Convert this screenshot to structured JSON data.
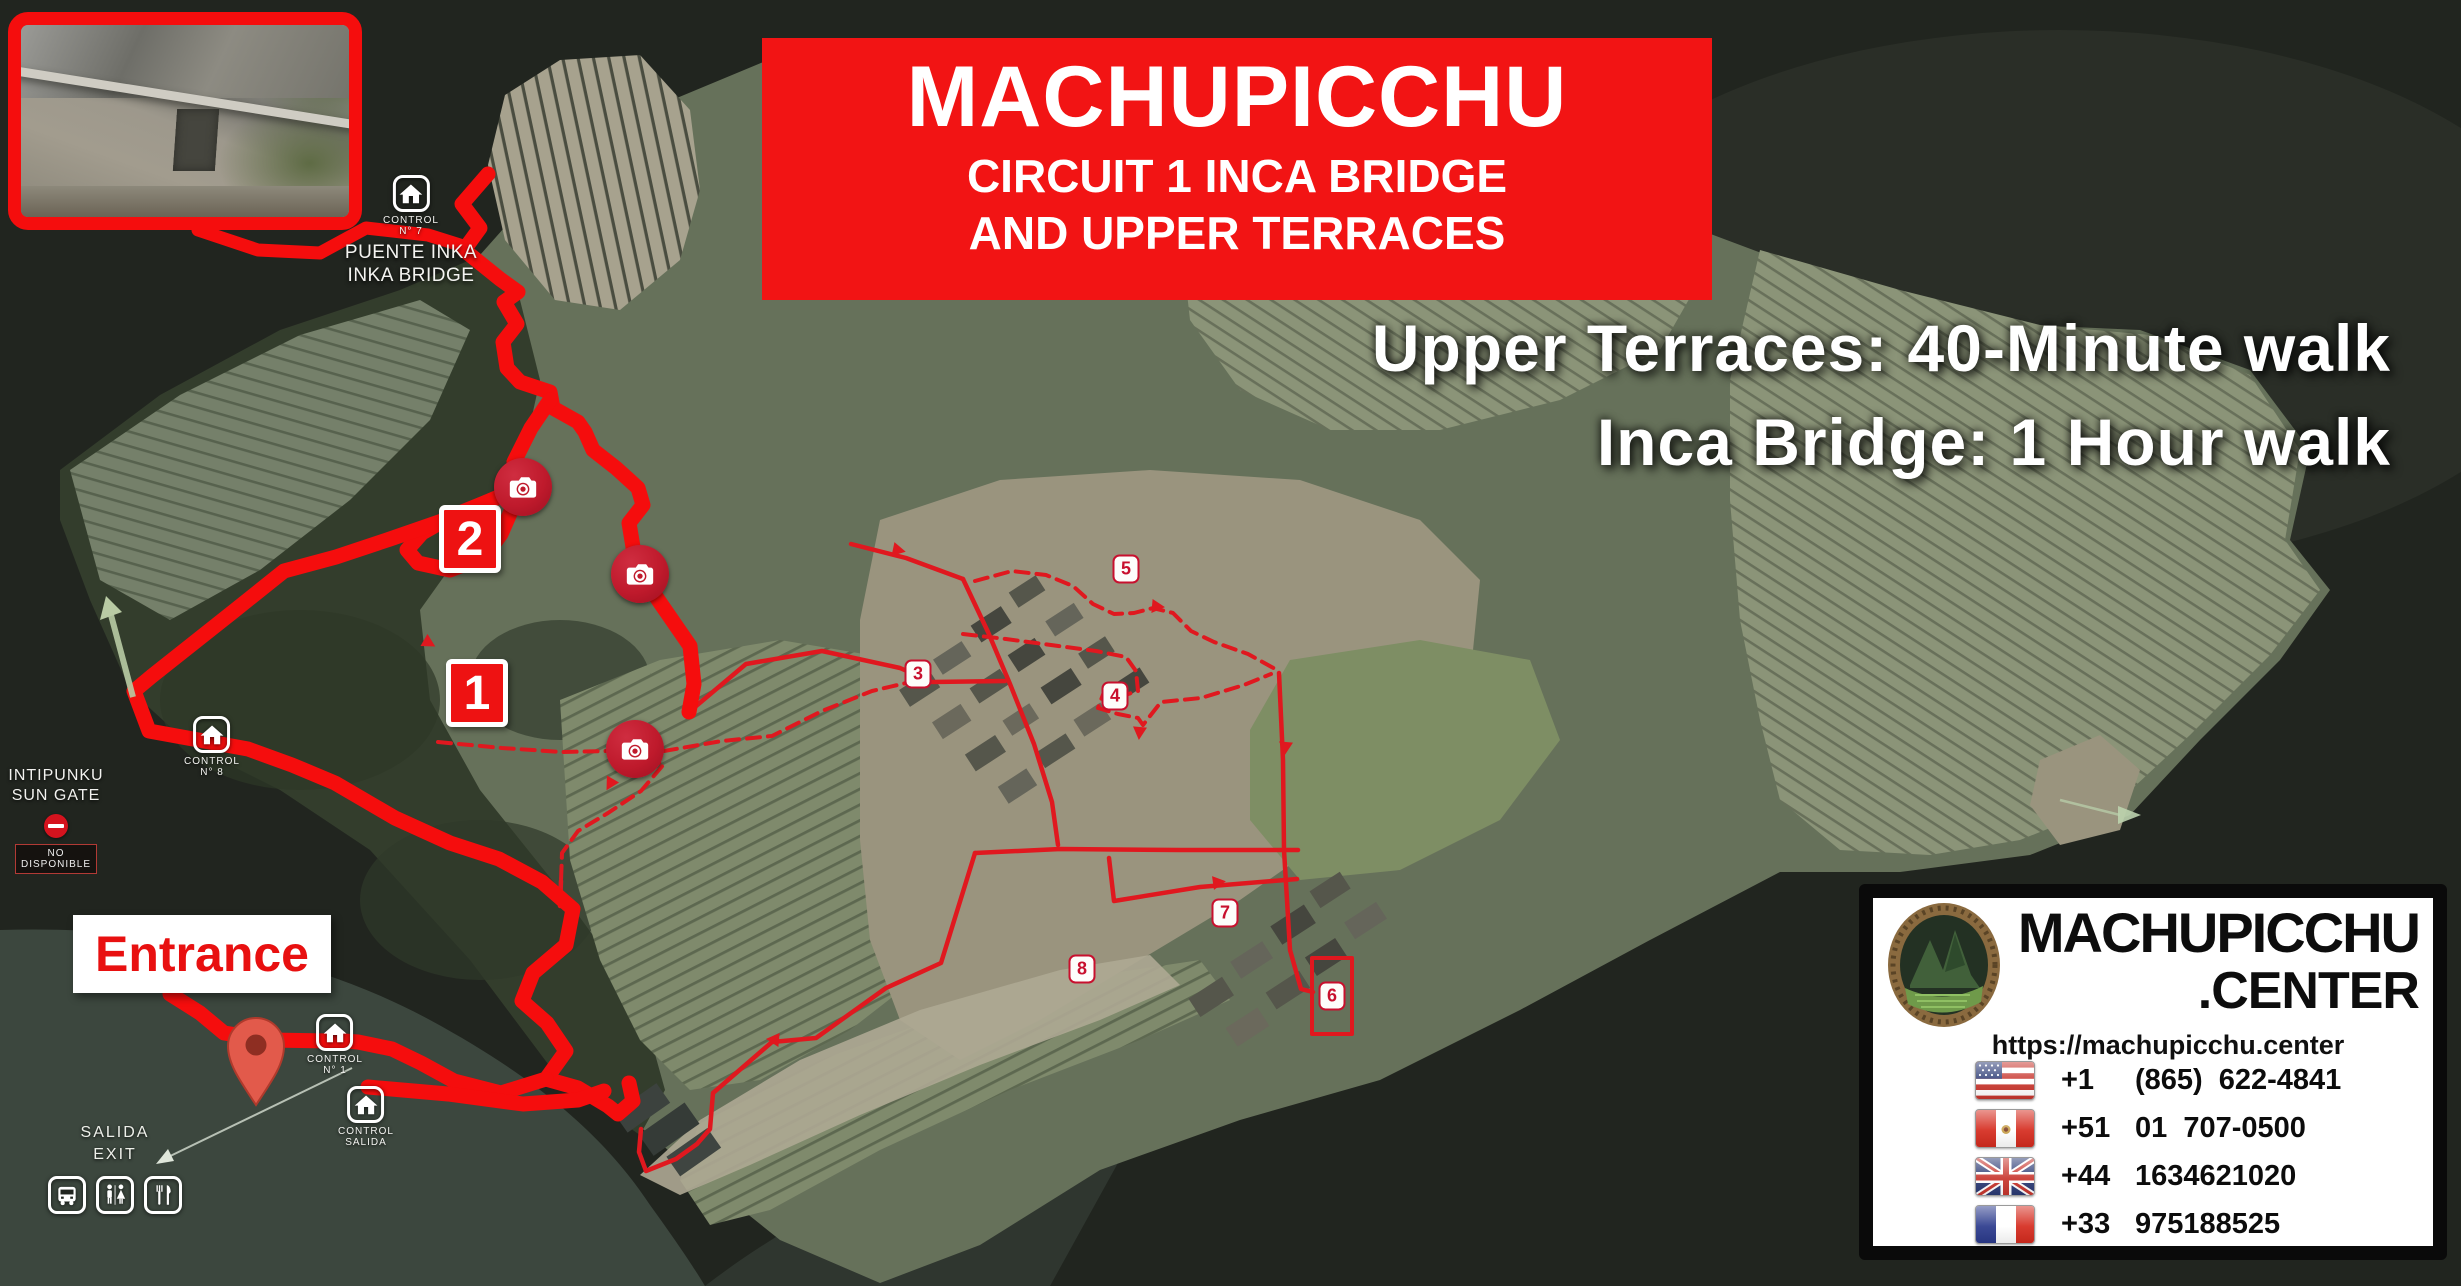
{
  "banner": {
    "title": "MACHUPICCHU",
    "subtitle_line1": "CIRCUIT 1 INCA BRIDGE",
    "subtitle_line2": "AND UPPER TERRACES"
  },
  "walk_info": {
    "line1": "Upper Terraces: 40-Minute walk",
    "line2": "Inca Bridge: 1 Hour walk"
  },
  "inka_bridge_station": {
    "control_label": "CONTROL",
    "control_number": "N° 7",
    "name_line1": "PUENTE INKA",
    "name_line2": "INKA BRIDGE"
  },
  "sun_gate": {
    "name_line1": "INTIPUNKU",
    "name_line2": "SUN GATE",
    "status_badge": "NO DISPONIBLE"
  },
  "control_1": {
    "control_label": "CONTROL",
    "control_number": "N° 1"
  },
  "control_8": {
    "control_label": "CONTROL",
    "control_number": "N° 8"
  },
  "control_exit": {
    "control_label": "CONTROL",
    "control_number": "SALIDA"
  },
  "entrance": {
    "label": "Entrance"
  },
  "exit_sign": {
    "line1": "SALIDA",
    "line2": "EXIT"
  },
  "route_stops": {
    "stop_1": "1",
    "stop_2": "2"
  },
  "waypoints": [
    "3",
    "4",
    "5",
    "6",
    "7",
    "8"
  ],
  "contact_card": {
    "brand_line1": "MACHUPICCHU",
    "brand_line2": ".CENTER",
    "url": "https://machupicchu.center",
    "phones": [
      {
        "country": "usa",
        "code": "+1",
        "number": "(865) 622-4841"
      },
      {
        "country": "peru",
        "code": "+51",
        "number": "01 707-0500"
      },
      {
        "country": "uk",
        "code": "+44",
        "number": "1634621020"
      },
      {
        "country": "france",
        "code": "+33",
        "number": "975188525"
      }
    ]
  },
  "colors": {
    "route_red": "#f50d0d",
    "detail_red": "#e0181f",
    "banner_red": "#f21414",
    "marker_red": "#ee1212",
    "badge_red": "#c8102e",
    "camera_red": "#bf1a2c",
    "pin_red": "#e25a4b",
    "text_white": "#ffffff"
  }
}
